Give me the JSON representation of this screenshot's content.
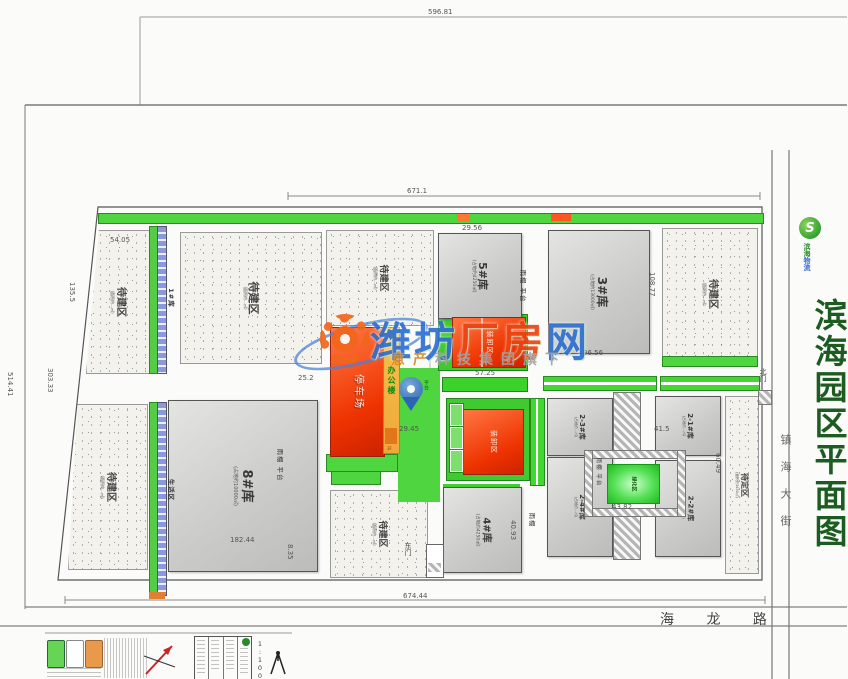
{
  "title_block": {
    "title": "滨海园区平面图",
    "logo_letter": "S",
    "logo_company_1": "滨海",
    "logo_company_2": "物流"
  },
  "streets": {
    "right_street": "镇海大街",
    "bottom_road": "海 龙 路"
  },
  "watermark": {
    "brand_blue1": "潍坊",
    "brand_red": "厂房",
    "brand_blue2": "网",
    "subtitle_accent": "意产",
    "subtitle_rest": "科技集团旗下"
  },
  "buildings": [
    {
      "label": "5#库",
      "sub": "(占地约4250㎡)"
    },
    {
      "label": "3#库",
      "sub": "(占地约13000㎡)"
    },
    {
      "label": "8#库",
      "sub": "(占地约10000㎡)"
    },
    {
      "label": "4#库",
      "sub": "(占地约4250㎡)"
    },
    {
      "label": "2-1#库",
      "sub": "(占地约…㎡)"
    },
    {
      "label": "2-2#库",
      "sub": "(占地约…㎡)"
    },
    {
      "label": "2-3#库",
      "sub": "(占地约…㎡)"
    },
    {
      "label": "2-4#库",
      "sub": "(占地约…㎡)"
    },
    {
      "label": "1#库"
    },
    {
      "label": "生活区"
    }
  ],
  "areas": [
    {
      "label": "待建区",
      "sub": "(面积约…㎡)"
    },
    {
      "label": "待建区",
      "sub": "(面积约…㎡)"
    },
    {
      "label": "待建区",
      "sub": "(面积约…㎡)"
    },
    {
      "label": "待建区",
      "sub": "(面积约…㎡)"
    },
    {
      "label": "待建区",
      "sub": "(面积约…㎡)"
    },
    {
      "label": "待建区",
      "sub": "(面积约…㎡)"
    },
    {
      "label": "待定区",
      "sub": "(面积约3450㎡)"
    }
  ],
  "facilities": {
    "parking": "停车场",
    "office": "办公楼",
    "office_floors": "3F",
    "loading": "装卸区",
    "green_box": "绿化区",
    "platform_small": "平台",
    "canopy_platform": "雨棚 平台",
    "canopy": "雨棚",
    "gate_east": "东门",
    "gate_north": "北门"
  },
  "dims": {
    "top_width": "596.81",
    "inner_width": "671.1",
    "bottom_width": "674.44",
    "left_height": "514.41",
    "left_mid": "303.33",
    "left_upper": "135.5",
    "top_left": "54.05",
    "w5": "29.56",
    "w3": "96.56",
    "h3": "108.77",
    "loading_w": "57.25",
    "green_w": "43.82",
    "court_w": "41.5",
    "office_w": "29.45",
    "w8": "182.44",
    "h8_gap": "8.35",
    "h4": "40.93",
    "right_h": "60.49",
    "gap8": "25.2"
  },
  "legend": {
    "scale": "1:1000"
  },
  "colors": {
    "accent_green": "#1d5c20",
    "belt_green": "#4fd53f",
    "hot_red": "#ee3300",
    "brand_blue": "#2f6fd0"
  }
}
